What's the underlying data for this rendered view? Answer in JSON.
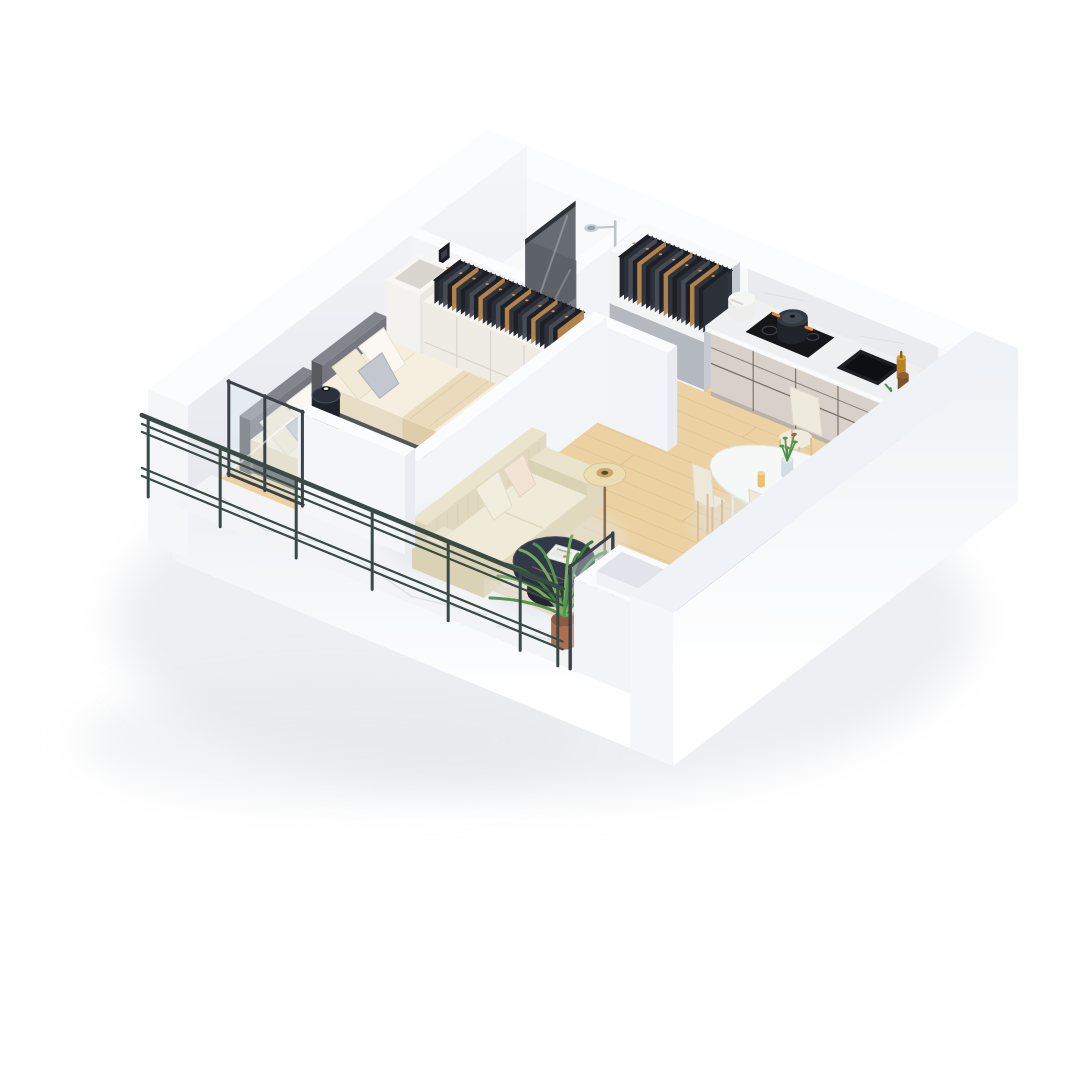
{
  "scene": {
    "type": "3d-floor-plan-render",
    "view": "isometric-dollhouse-cutaway",
    "background": "#ffffff",
    "rooms": [
      {
        "id": "bedroom",
        "floor": "light-oak",
        "furniture": [
          "single-bed-left",
          "single-bed-right",
          "round-nightstand",
          "alarm-clock",
          "wardrobe-with-clothes",
          "wall-niche-shelf",
          "balcony-glass-door"
        ]
      },
      {
        "id": "bathroom",
        "floor": "white-marble",
        "furniture": [
          "walk-in-shower",
          "smoked-glass-screen",
          "chrome-shower-set",
          "wall-control-panel"
        ]
      },
      {
        "id": "hallway",
        "floor": "white-marble",
        "furniture": [
          "open-closet-with-clothes"
        ]
      },
      {
        "id": "kitchen",
        "floor": "light-oak",
        "furniture": [
          "cabinet-run",
          "marble-countertop",
          "induction-hob",
          "cooking-pot",
          "bread-bin",
          "undermount-sink",
          "oil-bottle",
          "storage-jars",
          "corner-niche"
        ]
      },
      {
        "id": "living-dining",
        "floor": "light-oak",
        "furniture": [
          "cream-sofa",
          "throw-pillows",
          "floor-lamp",
          "round-coffee-table",
          "magazines",
          "tv-panel",
          "oval-dining-table",
          "dining-chairs",
          "flower-vase",
          "fruit",
          "juice-glass"
        ]
      },
      {
        "id": "balcony",
        "floor": "white-marble",
        "furniture": [
          "metal-railing",
          "potted-palm",
          "glass-wind-screen",
          "planter-niche"
        ]
      }
    ]
  },
  "colors": {
    "background": "#ffffff",
    "shadow": "#e2e5e9",
    "wallTop": "#fbfcfe",
    "wallInner": "#f3f4f7",
    "wallInnerLight": "#f8f9fb",
    "wallShade": "#e9ebf0",
    "wallBlue": "#ccd8e4",
    "wallBlueLight": "#e9eff6",
    "wallEnd": "#f4f6f8",
    "woodFloor": "#ecd2a2",
    "woodLine": "#d4b37e",
    "marble": "#f3f4f6",
    "marbleVein": "#d4d8de",
    "cabinet": "#d8d1c9",
    "cabinetSeam": "#6e665c",
    "cabinetSide": "#c9c3bb",
    "counter": "#eef0f2",
    "backsplash": "#e9ebee",
    "wardrobe": "#efece6",
    "wardrobeSeam": "#d6d1c8",
    "headboard": "#6b6b72",
    "bedFrame": "#55555c",
    "linen": "#f6efe0",
    "linenShade": "#e7dcc4",
    "blanket": "#e9dbbc",
    "pillowWhite": "#faf8f0",
    "pillowAccent": "#c3c7ce",
    "pillowBlush": "#f3e3d2",
    "sofa": "#eae4cc",
    "sofaShade": "#d9d2b5",
    "sofaSide": "#e0d9c0",
    "lampShade": "#ecdcb2",
    "lampPole": "#8a6f52",
    "tableDark": "#2a303e",
    "tableDarkTop": "#313848",
    "tv": "#23272f",
    "tvBase": "#383e46",
    "chair": "#efeade",
    "chairLeg": "#d9c09a",
    "tableWhite": "#f6f7f7",
    "railing": "#3a4a44",
    "glass": "#dfeaf1",
    "glassFrame": "#3b4148",
    "showerGlass": "#5b6067",
    "chrome": "#bcc4cb",
    "pot": "#ad6f4e",
    "plantDark": "#3c7a3b",
    "plantMid": "#55944e",
    "plantLight": "#74ae62",
    "clothesA": "#1d2026",
    "clothesB": "#2c313a",
    "clothesC": "#474c56",
    "clothesTan": "#b8854c",
    "hanger": "#cb9455",
    "orange": "#e8872c",
    "flowerGreen": "#4c8f46",
    "oil": "#bb8224",
    "jar": "#7c5230"
  }
}
